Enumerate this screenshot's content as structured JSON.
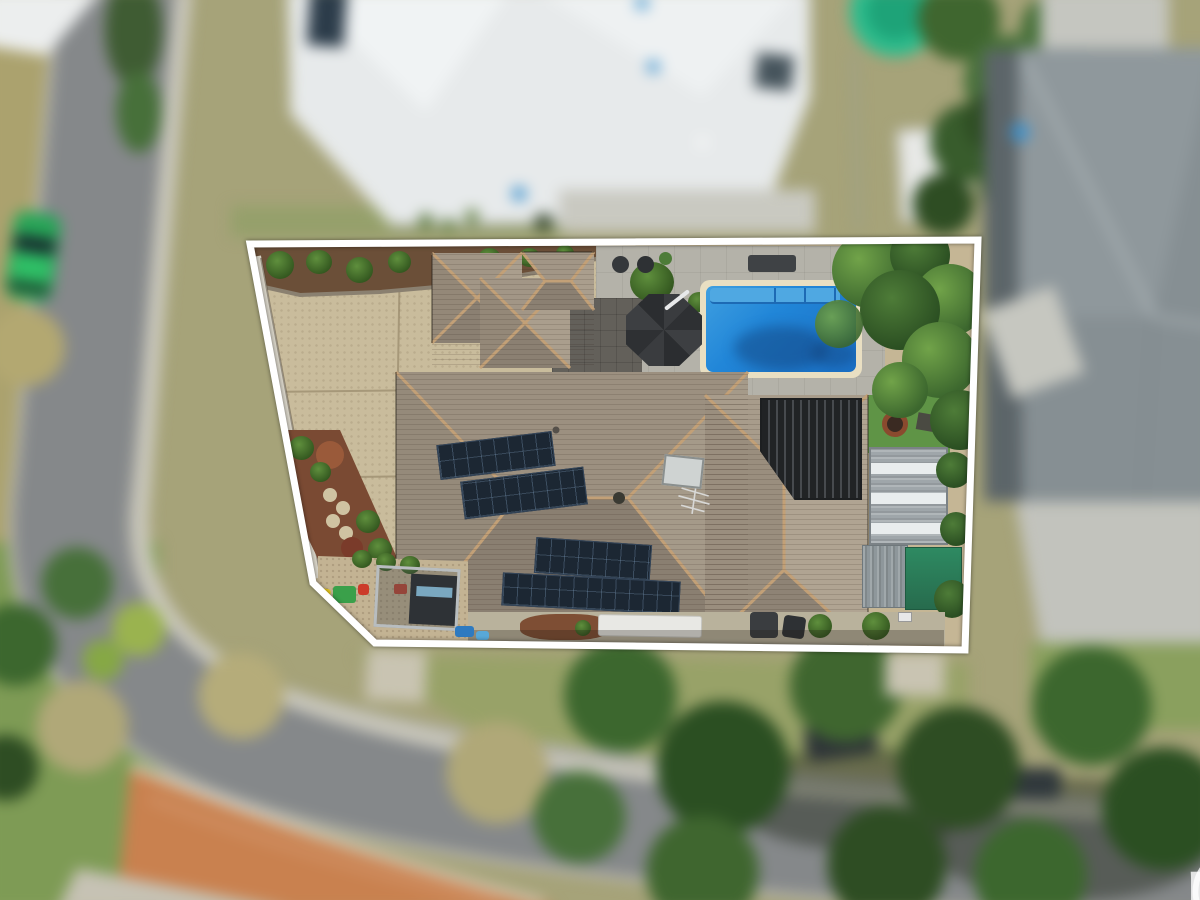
{
  "watermark": {
    "at_symbol": "@",
    "brand": "realty",
    "full_text": "@realty",
    "color": "#ffffff"
  },
  "scene": {
    "type": "aerial-drone-photograph",
    "subject": "residential lot highlighted with white boundary outline; surroundings blurred",
    "boundary_color": "#ffffff",
    "palette": {
      "pool_water": "#1d7ed6",
      "pool_coping": "#e9dfc2",
      "roof_tiles": "#978c7d",
      "ridge_caps": "#c2a077",
      "driveway_concrete": "#c9bc9c",
      "solar_panels": "#1c2733",
      "pergola_louvres": "#2a2c2e",
      "metal_shed": "#9fa6aa",
      "green_roof": "#2e7a58",
      "road_asphalt": "#85888a",
      "brick_paving": "#c9814f",
      "neighbour_roof_white": "#e7eaeb",
      "neighbour_roof_grey": "#868f93",
      "parked_car_green": "#27a557"
    },
    "features": [
      "tiled hip roof with solar panel arrays",
      "swimming pool with cream coping",
      "octagonal cantilever umbrella",
      "louvred pergola",
      "metal shed with skylight strips",
      "green flat roof",
      "exposed aggregate driveway",
      "garden beds with mulch and shrubs",
      "trampoline and play equipment",
      "fire pit on lawn",
      "white caravan",
      "street with parked green car",
      "orange brick traffic paving",
      "surrounding trees and lawns"
    ]
  }
}
